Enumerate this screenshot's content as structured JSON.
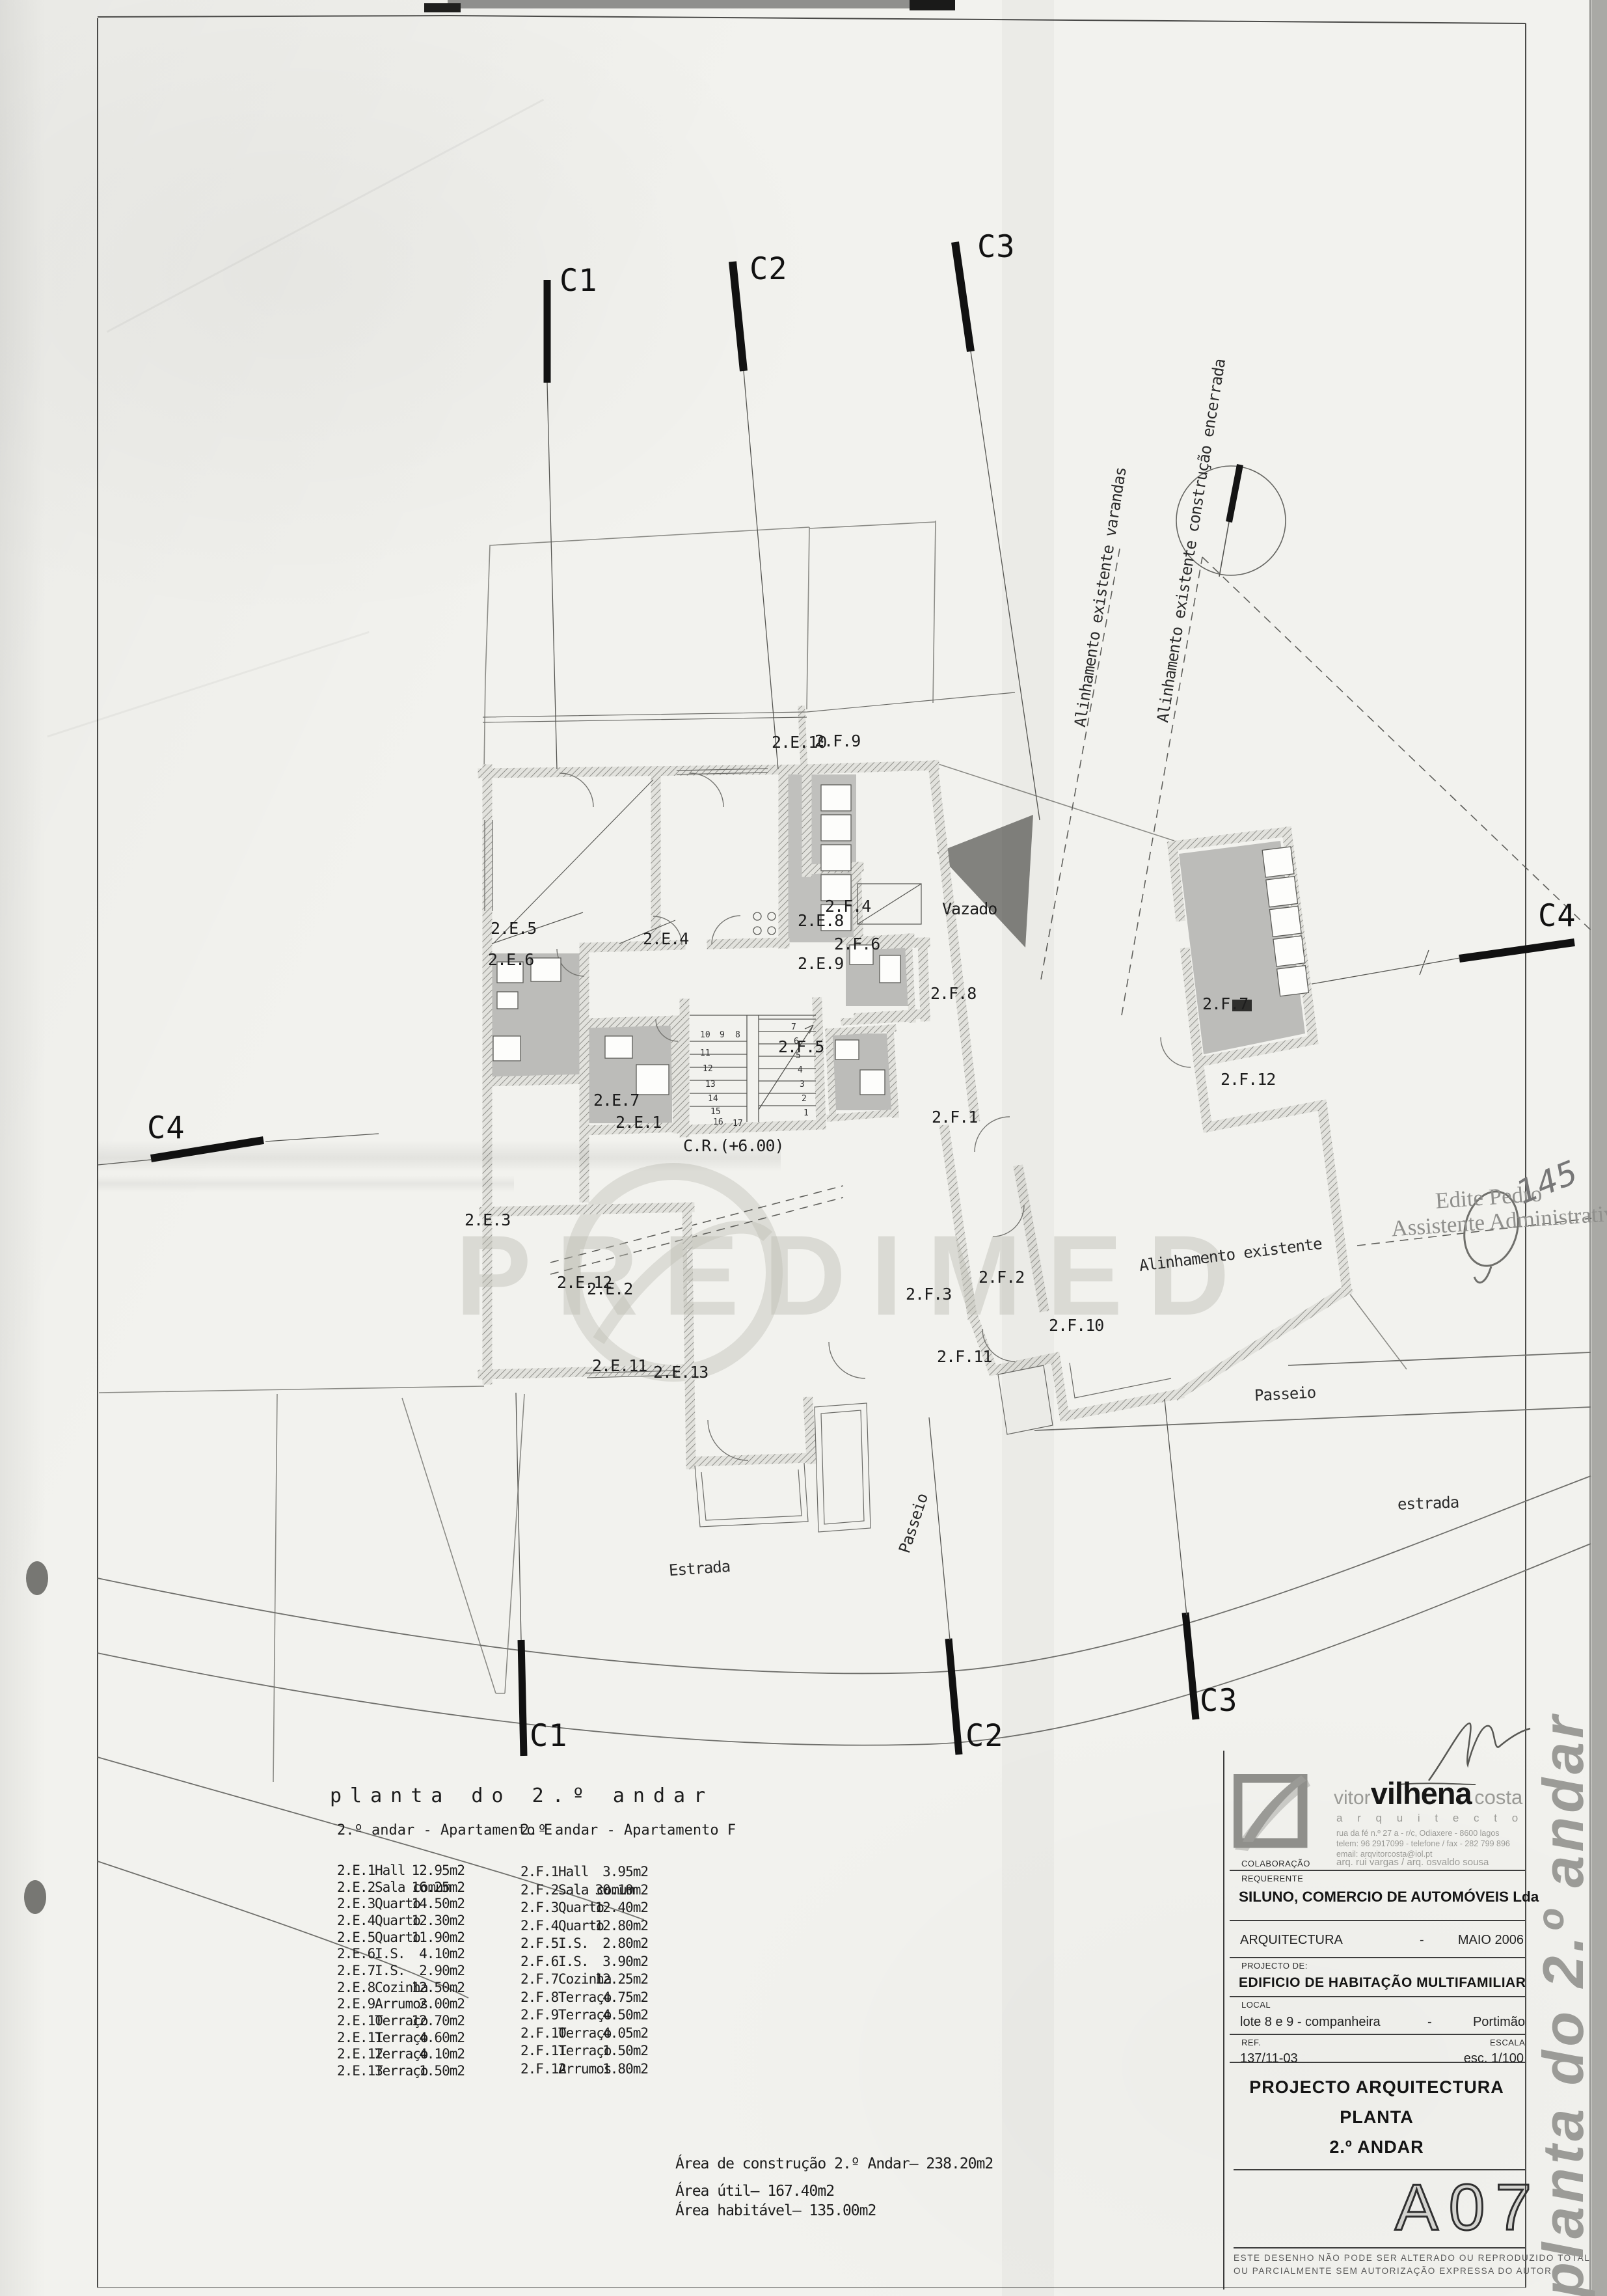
{
  "colors": {
    "paper": "#f2f2ee",
    "line": "#3a3a3a",
    "wet_area": "#bcbcb9",
    "void_fill": "#82827e",
    "brand_gray": "#9a9a96"
  },
  "section_markers": {
    "c1": "C1",
    "c2": "C2",
    "c3": "C3",
    "c4": "C4"
  },
  "plan": {
    "rooms": {
      "e1": "2.E.1",
      "e2": "2.E.2",
      "e3": "2.E.3",
      "e4": "2.E.4",
      "e5": "2.E.5",
      "e6": "2.E.6",
      "e7": "2.E.7",
      "e8": "2.E.8",
      "e9": "2.E.9",
      "e10": "2.E.10",
      "e11": "2.E.11",
      "e12": "2.E.12",
      "e13": "2.E.13",
      "f1": "2.F.1",
      "f2": "2.F.2",
      "f3": "2.F.3",
      "f4": "2.F.4",
      "f5": "2.F.5",
      "f6": "2.F.6",
      "f7": "2.F.7",
      "f8": "2.F.8",
      "f9": "2.F.9",
      "f10": "2.F.10",
      "f11": "2.F.11",
      "f12": "2.F.12"
    },
    "annotations": {
      "vazado": "Vazado",
      "cota": "C.R.(+6.00)",
      "alinhamento_varandas": "Alinhamento existente varandas",
      "alinhamento_construcao": "Alinhamento existente construção encerrada",
      "alinhamento_existente": "Alinhamento existente",
      "estrada_cap": "Estrada",
      "estrada_low": "estrada",
      "passeio": "Passeio"
    },
    "stairs": {
      "steps": [
        "1",
        "2",
        "3",
        "4",
        "5",
        "6",
        "7",
        "8",
        "9",
        "10",
        "11",
        "12",
        "13",
        "14",
        "15",
        "16",
        "17"
      ]
    },
    "watermark": "PREDIMED"
  },
  "stamp": {
    "line1": "Edite Pedro",
    "line2": "Assistente Administrativa",
    "number": "145"
  },
  "legend": {
    "title": "planta do 2.º andar",
    "apartment_e": {
      "heading": "2.º andar - Apartamento E",
      "rows": [
        {
          "code": "2.E.1",
          "name": "Hall",
          "area": "12.95m2"
        },
        {
          "code": "2.E.2",
          "name": "Sala comum",
          "area": "16.25m2"
        },
        {
          "code": "2.E.3",
          "name": "Quarto",
          "area": "14.50m2"
        },
        {
          "code": "2.E.4",
          "name": "Quarto",
          "area": "12.30m2"
        },
        {
          "code": "2.E.5",
          "name": "Quarto",
          "area": "11.90m2"
        },
        {
          "code": "2.E.6",
          "name": "I.S.",
          "area": "4.10m2"
        },
        {
          "code": "2.E.7",
          "name": "I.S.",
          "area": "2.90m2"
        },
        {
          "code": "2.E.8",
          "name": "Cozinha",
          "area": "12.50m2"
        },
        {
          "code": "2.E.9",
          "name": "Arrumos",
          "area": "2.00m2"
        },
        {
          "code": "2.E.10",
          "name": "Terraço",
          "area": "12.70m2"
        },
        {
          "code": "2.E.11",
          "name": "Terraço",
          "area": "4.60m2"
        },
        {
          "code": "2.E.12",
          "name": "Terraço",
          "area": "4.10m2"
        },
        {
          "code": "2.E.13",
          "name": "Terraço",
          "area": "1.50m2"
        }
      ]
    },
    "apartment_f": {
      "heading": "2.º andar - Apartamento F",
      "rows": [
        {
          "code": "2.F.1",
          "name": "Hall",
          "area": "3.95m2"
        },
        {
          "code": "2.F.2",
          "name": "Sala comum",
          "area": "30.10m2"
        },
        {
          "code": "2.F.3",
          "name": "Quarto",
          "area": "12.40m2"
        },
        {
          "code": "2.F.4",
          "name": "Quarto",
          "area": "12.80m2"
        },
        {
          "code": "2.F.5",
          "name": "I.S.",
          "area": "2.80m2"
        },
        {
          "code": "2.F.6",
          "name": "I.S.",
          "area": "3.90m2"
        },
        {
          "code": "2.F.7",
          "name": "Cozinha",
          "area": "12.25m2"
        },
        {
          "code": "2.F.8",
          "name": "Terraço",
          "area": "4.75m2"
        },
        {
          "code": "2.F.9",
          "name": "Terraço",
          "area": "4.50m2"
        },
        {
          "code": "2.F.10",
          "name": "Terraço",
          "area": "4.05m2"
        },
        {
          "code": "2.F.11",
          "name": "Terraço",
          "area": "1.50m2"
        },
        {
          "code": "2.F.12",
          "name": "Arrumos",
          "area": "1.80m2"
        }
      ]
    },
    "summary": {
      "construction": "Área de construção 2.º Andar– 238.20m2",
      "useful": "Área útil– 167.40m2",
      "habitable": "Área habitável– 135.00m2"
    }
  },
  "title_block": {
    "brand_first": "vitor",
    "brand_last": "vilhena",
    "brand_surname": "costa",
    "brand_profession": "a r q u i t e c t o",
    "address": "rua da fé  n.º 27 a  -  r/c,  Odiaxere   -   8600 lagos",
    "phone": "telem:  96 2917099    -    telefone / fax  -  282 799 896",
    "email": "email:   arqvitorcosta@iol.pt",
    "collaboration_label": "COLABORAÇÃO",
    "collaborators": "arq. rui vargas / arq. osvaldo sousa",
    "client_label": "REQUERENTE",
    "client": "SILUNO, COMERCIO DE AUTOMÓVEIS Lda",
    "discipline": "ARQUITECTURA",
    "dash1": "-",
    "date": "MAIO 2006",
    "project_label": "PROJECTO DE:",
    "project": "EDIFICIO DE HABITAÇÃO MULTIFAMILIAR",
    "local_label": "LOCAL",
    "local": "lote 8 e 9 - companheira",
    "dash2": "-",
    "city": "Portimão",
    "ref_label": "REF.",
    "ref": "137/11-03",
    "scale_label": "ESCALA",
    "scale": "esc.  1/100",
    "doc_title1": "PROJECTO ARQUITECTURA",
    "doc_title2": "PLANTA",
    "doc_title3": "2.º ANDAR",
    "num_a": "A",
    "num_0": "0",
    "num_7": "7",
    "disclaimer1": "ESTE DESENHO NÃO PODE SER ALTERADO OU REPRODUZIDO TOTAL",
    "disclaimer2": "OU PARCIALMENTE SEM AUTORIZAÇÃO EXPRESSA DO AUTOR",
    "side_title": "planta do 2.º andar"
  }
}
